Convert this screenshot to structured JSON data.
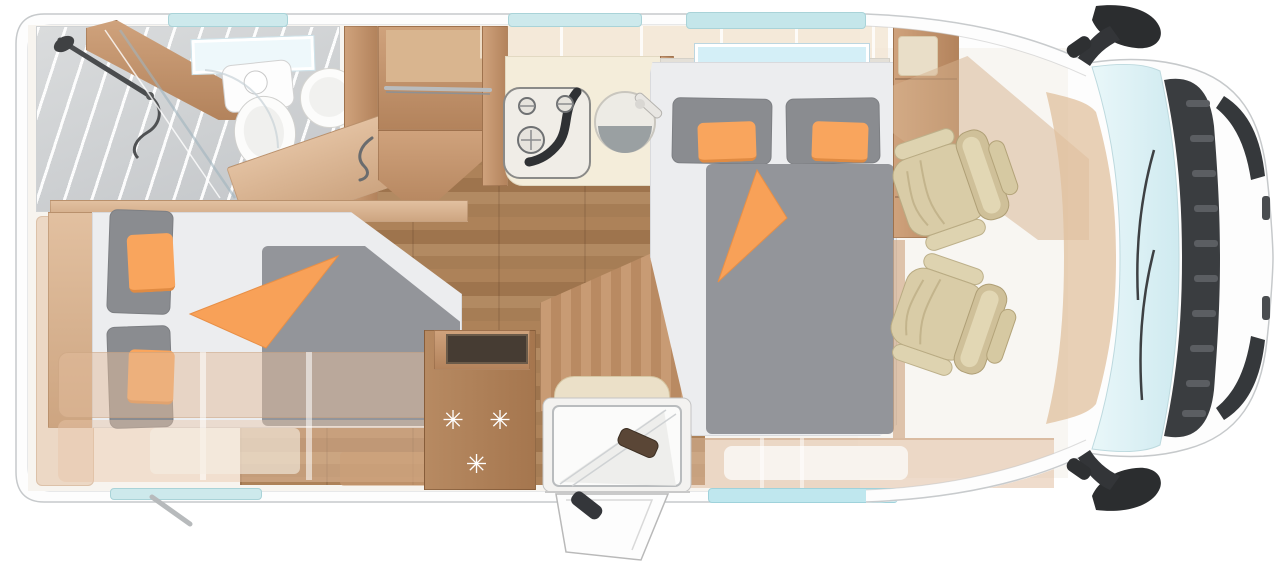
{
  "title": "motorhome-floorplan-top-view",
  "fridge": {
    "stars_label": "✳ ✳ ✳"
  },
  "colors": {
    "accent_orange": "#F9A45C",
    "mattress_gray": "#94969A",
    "seat_beige": "#D8CBA6",
    "wood": "#BE9068",
    "floor_wood": "#A87E56",
    "window_teal": "#C9E9EE",
    "skylight_blue": "#D4EFF7",
    "detail_dark": "#3A3D40",
    "body_white": "#FDFDFD"
  },
  "features": {
    "bathroom": [
      "shower",
      "shower-fixture",
      "toilet",
      "washbasin",
      "vanity-door",
      "roof-window"
    ],
    "wardrobe": [
      "clothes-rail"
    ],
    "kitchen": [
      "three-burner-cooktop",
      "round-sink",
      "overhead-lockers",
      "worktop"
    ],
    "refrigerator": [
      "freezer-stars"
    ],
    "beds": [
      "single-bed-rear",
      "double-bed-center",
      "orange-cushions",
      "folded-orange-blanket"
    ],
    "entrance": [
      "entry-door-open",
      "entry-step",
      "bench-seat"
    ],
    "cab": [
      "driver-swivel-seat",
      "passenger-swivel-seat",
      "dashboard",
      "windshield",
      "front-grille",
      "side-mirror-top",
      "side-mirror-bottom"
    ],
    "windows": [
      "top-window-1",
      "top-window-2",
      "top-window-3",
      "bottom-window-1",
      "bottom-window-2",
      "bathroom-skylight",
      "bedroom-skylight"
    ]
  }
}
